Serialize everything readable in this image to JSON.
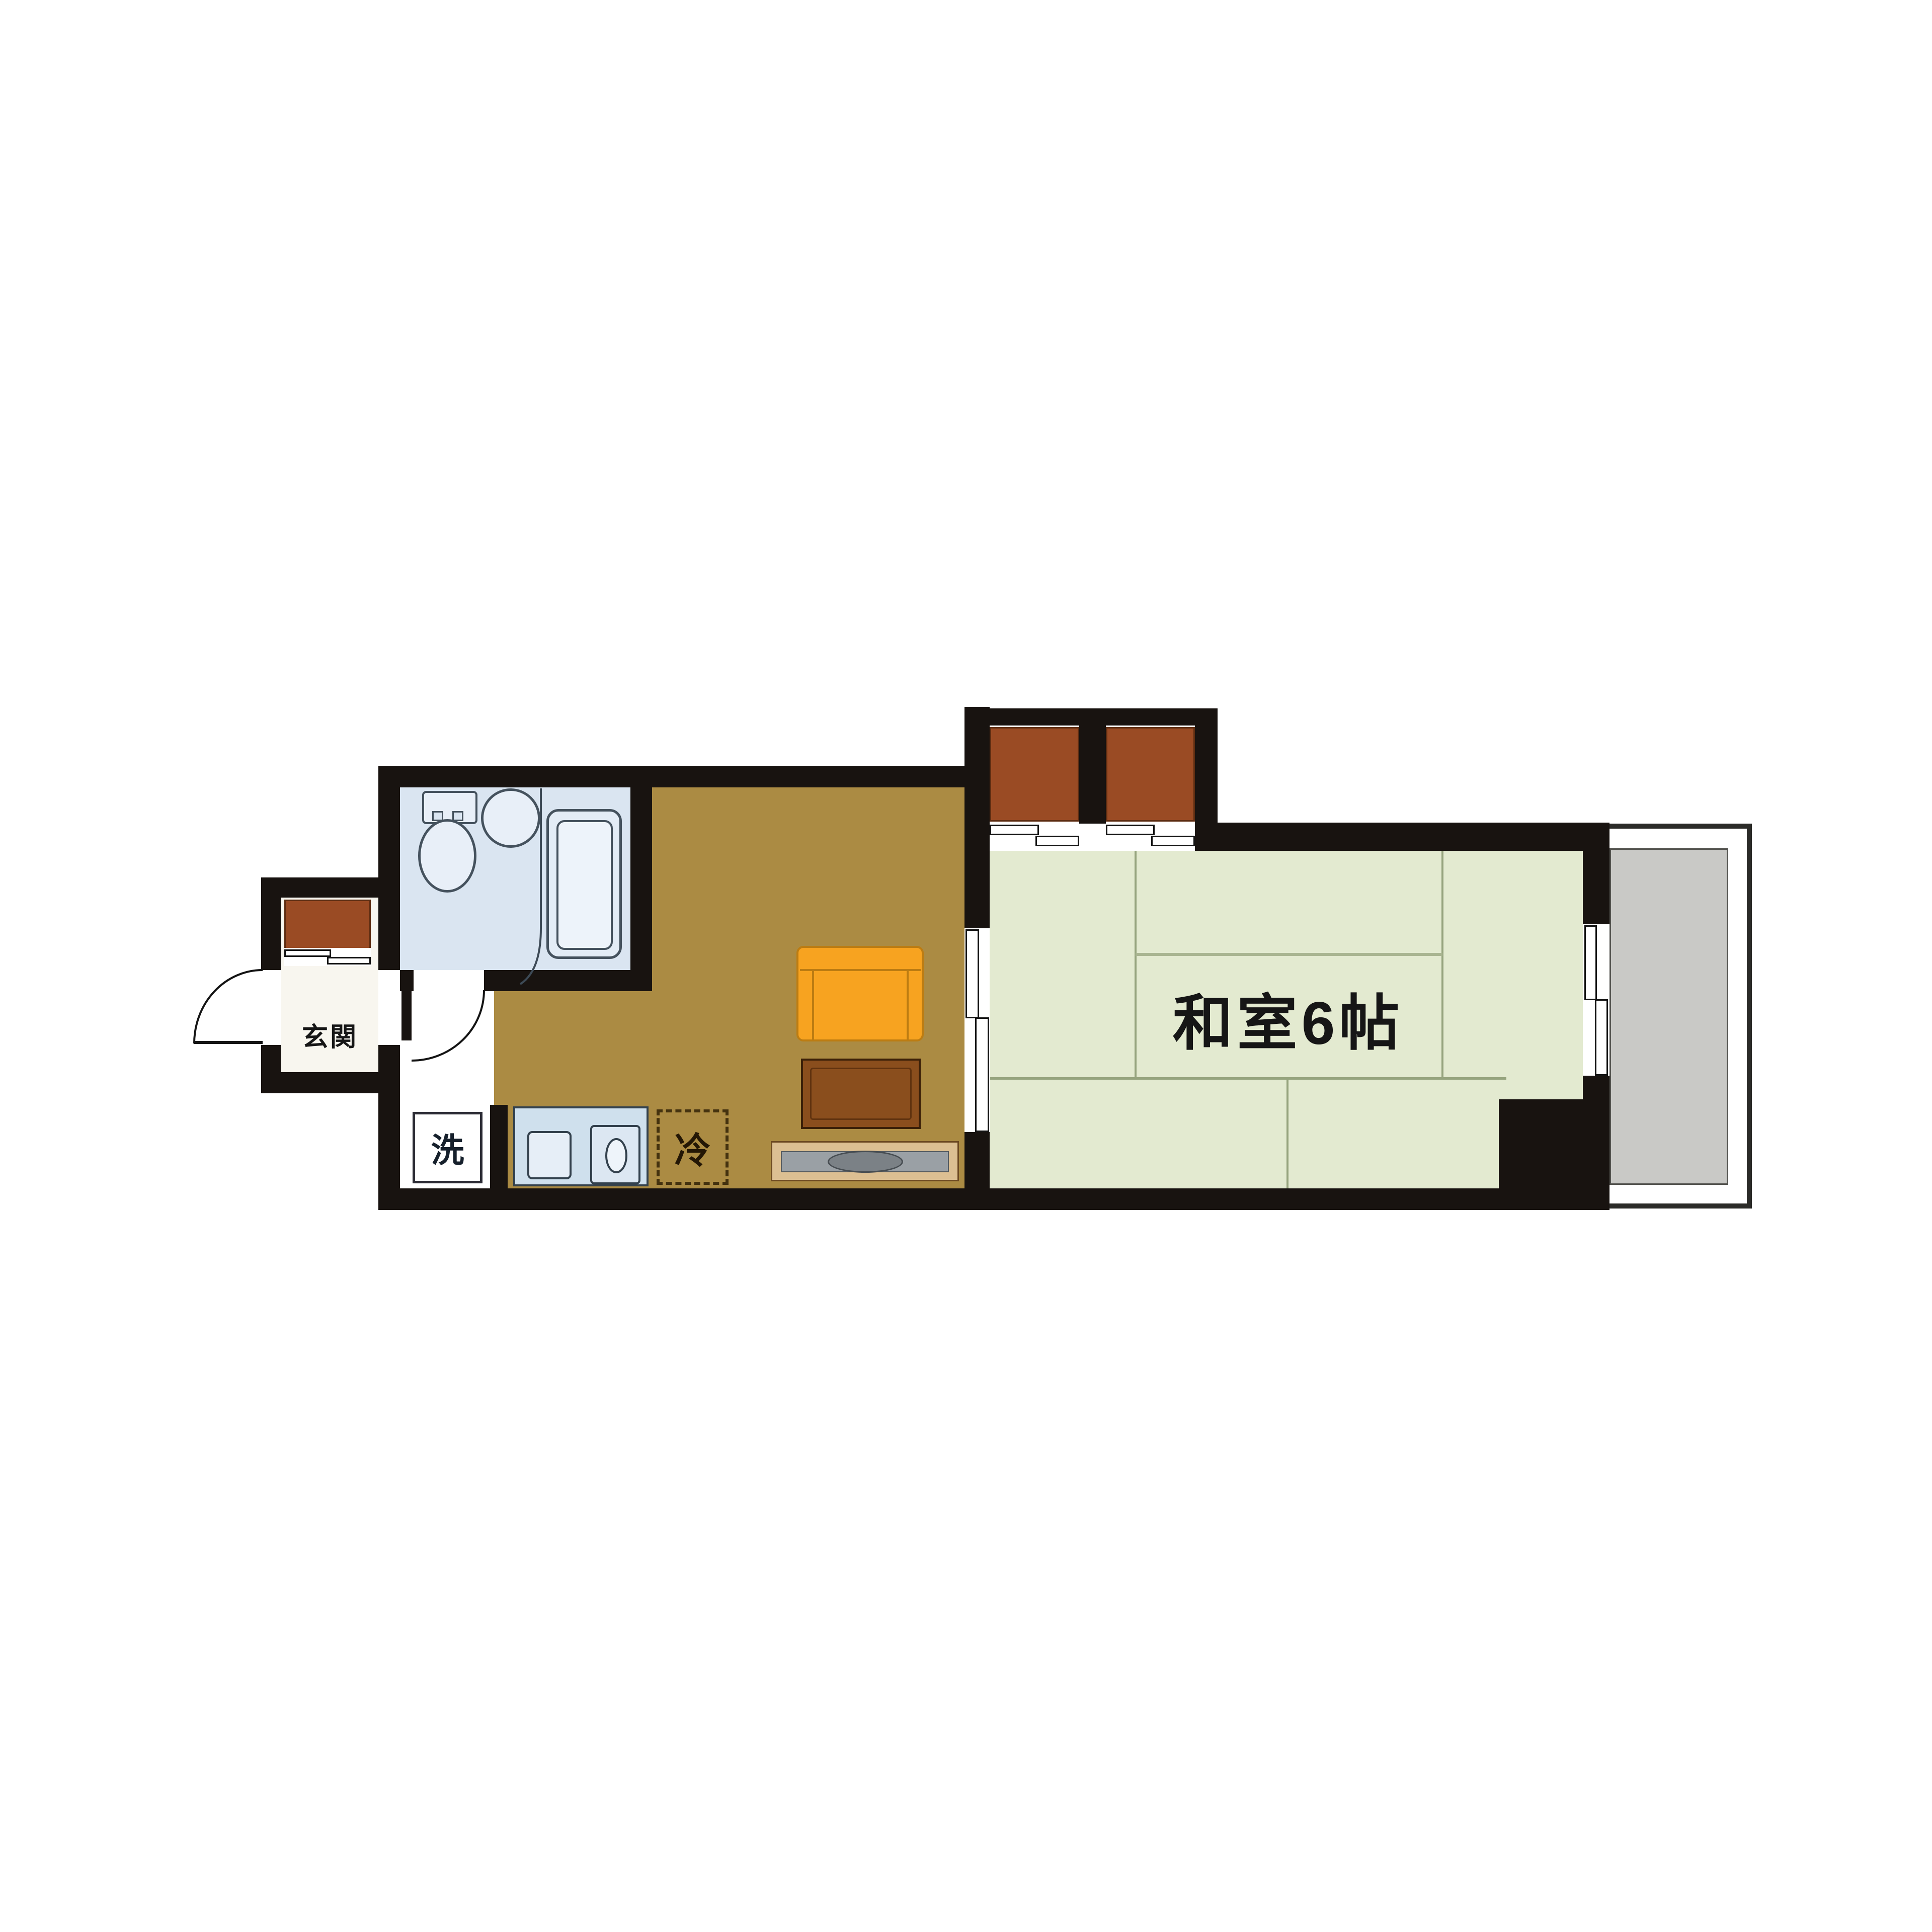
{
  "document": {
    "type": "apartment-floor-plan",
    "background": "#ffffff"
  },
  "labels": {
    "tatami_room": "和室6帖",
    "entrance": "玄関",
    "washing_machine": "洗",
    "refrigerator": "冷"
  },
  "colors": {
    "wall": "#181310",
    "kitchen_floor": "#ab8b43",
    "tatami_floor": "#e3ead0",
    "tatami_line": "#96a47e",
    "closet": "#9a4b24",
    "bathroom_floor": "#dae5f1",
    "fixture_outline": "#45525e",
    "counter": "#cfe0ed",
    "balcony_floor": "#c9c9c6",
    "sofa": "#f7a320",
    "table": "#8a4e1d",
    "tv_board": "#dcbf92",
    "tv_gray": "#9aa0a5",
    "genkan_floor": "#f8f6ef",
    "text": "#161616"
  },
  "symbols": [
    "entrance-door-swing",
    "shoe-cabinet",
    "bathroom-door-swing",
    "toilet",
    "round-sink",
    "bathtub",
    "washing-machine-space",
    "kitchen-counter-sink",
    "refrigerator-space",
    "sofa",
    "low-table",
    "tv-board",
    "closet-sliding-doors",
    "room-sliding-door",
    "sliding-window",
    "balcony",
    "pillar"
  ]
}
